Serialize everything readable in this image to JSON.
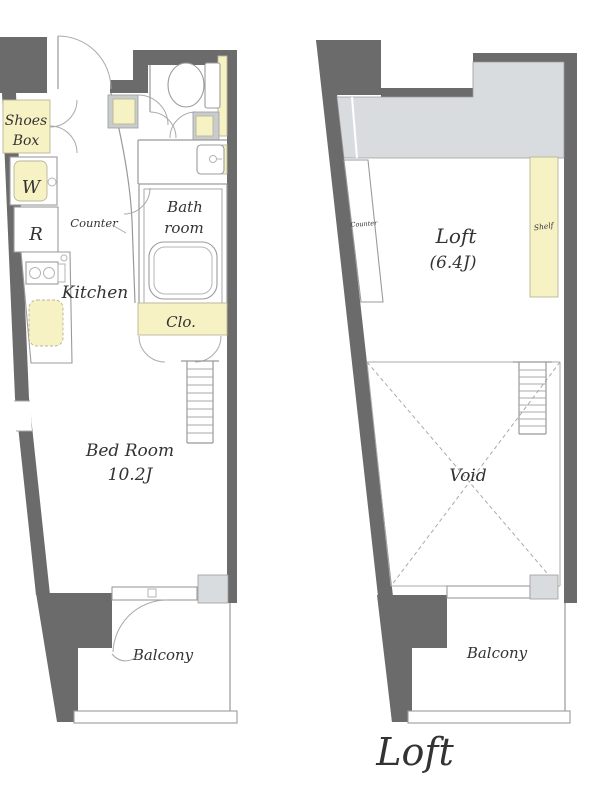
{
  "floor_plan": {
    "page_title": "Loft",
    "left": {
      "shoes_box_line1": "Shoes",
      "shoes_box_line2": "Box",
      "washer": "W",
      "fridge": "R",
      "counter": "Counter",
      "kitchen": "Kitchen",
      "bath_line1": "Bath",
      "bath_line2": "room",
      "closet": "Clo.",
      "bedroom_line1": "Bed Room",
      "bedroom_line2": "10.2J",
      "balcony": "Balcony"
    },
    "right": {
      "counter": "Counter",
      "shelf": "Shelf",
      "loft_line1": "Loft",
      "loft_line2": "(6.4J)",
      "void": "Void",
      "balcony": "Balcony"
    },
    "colors": {
      "wall": "#6b6b6b",
      "accent_yellow": "#f6f2c4",
      "light_gray": "#d9dcde",
      "line": "#999999",
      "text": "#333333"
    }
  }
}
